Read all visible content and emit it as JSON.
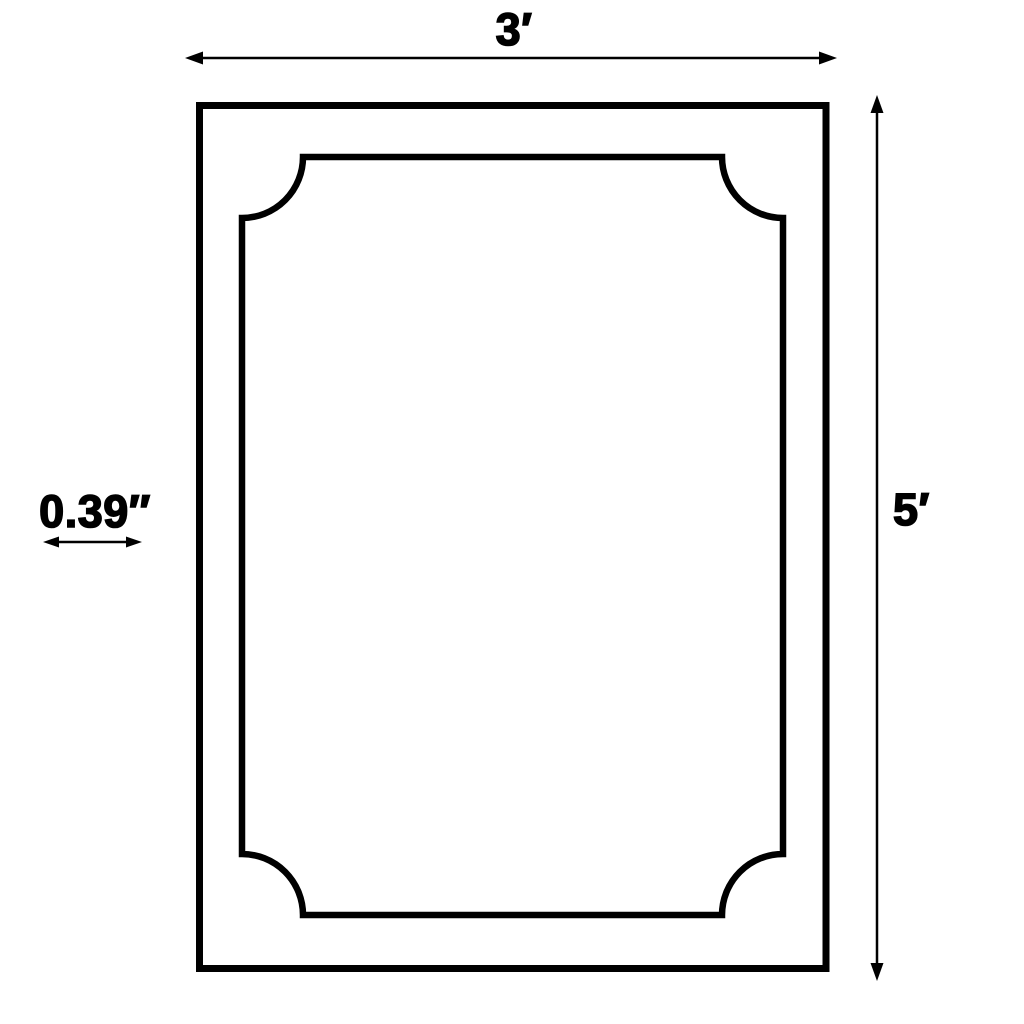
{
  "diagram": {
    "kind": "product-dimension-diagram",
    "labels": {
      "width": "3′",
      "height": "5′",
      "border_thickness": "0.39″"
    },
    "colors": {
      "line": "#000000",
      "background": "#ffffff"
    }
  }
}
